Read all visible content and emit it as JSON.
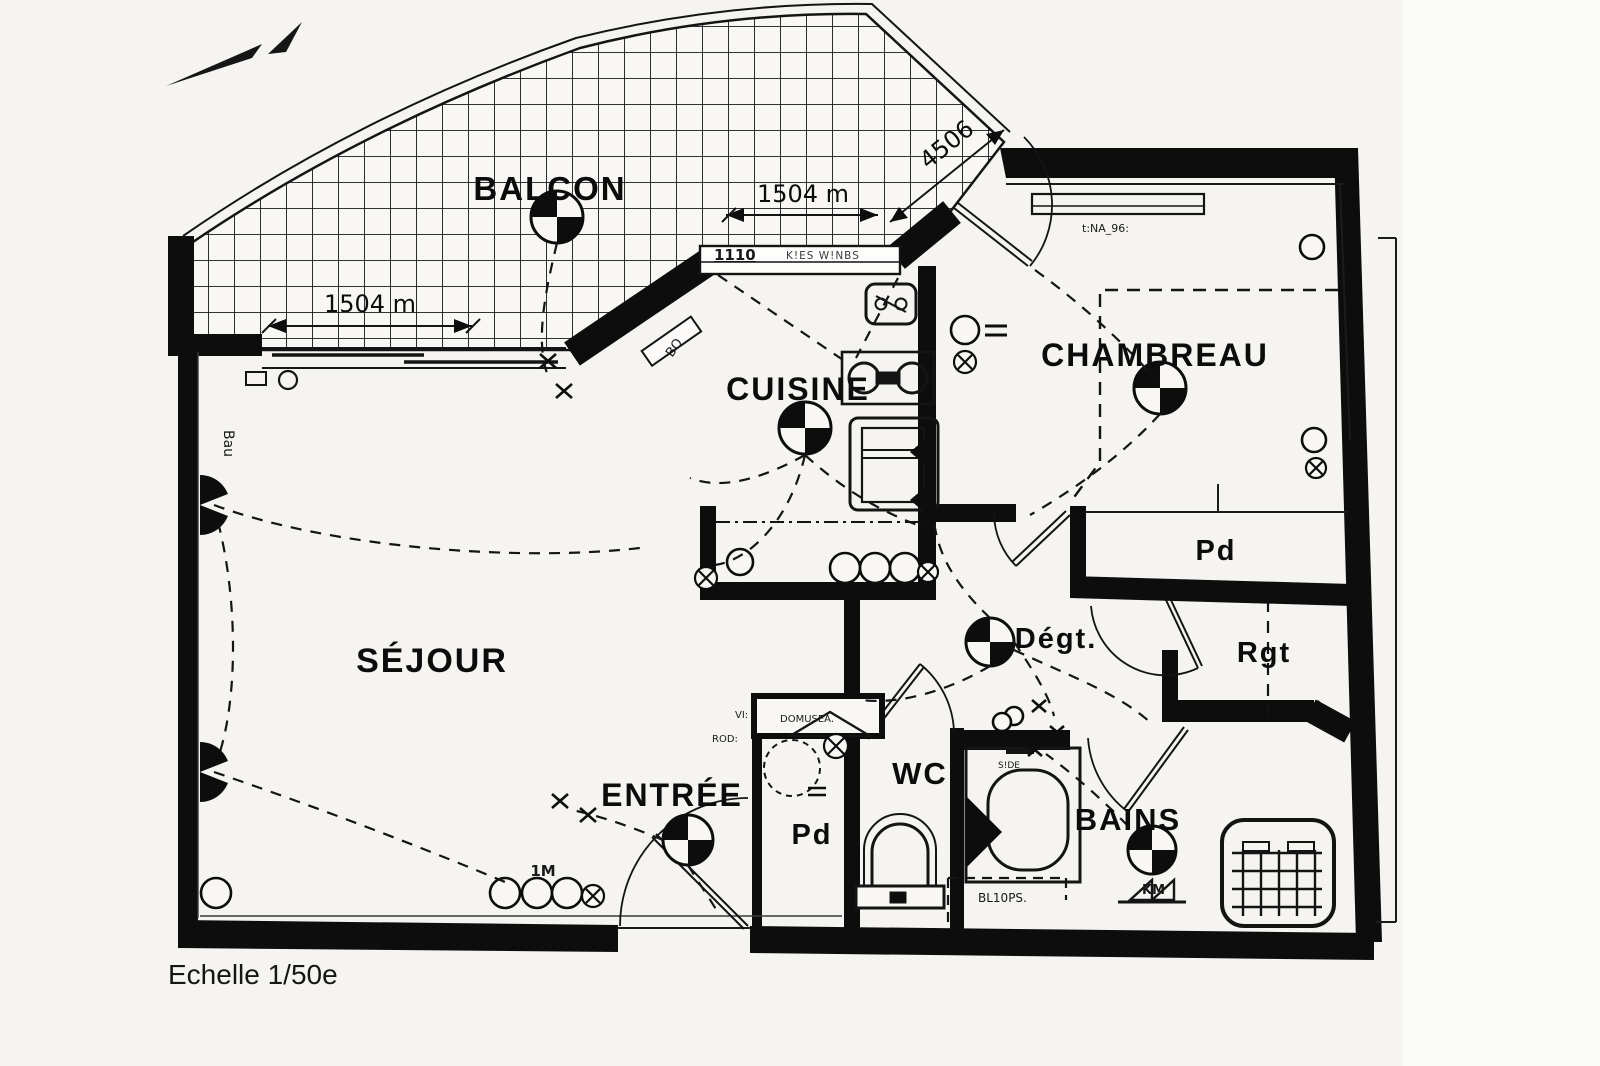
{
  "meta": {
    "scale_label": "Echelle 1/50e"
  },
  "rooms": {
    "balcon": "BALCON",
    "cuisine": "CUISINE",
    "chambre": "CHAMBREAU",
    "sejour": "SÉJOUR",
    "entree": "ENTRÉE",
    "wc": "WC",
    "bains": "BAINS",
    "degagement": "Dégt.",
    "placard_chambre": "Pd",
    "placard_entree": "Pd",
    "rangement": "Rgt"
  },
  "dimensions": {
    "balcony_width": "1504 m",
    "kitchen_front": "1504 m",
    "diagonal": "4506",
    "kitchen_window": "1110"
  },
  "annotations": {
    "outlet_group": "1M",
    "door_bo": "BO",
    "wall_bau": "Bau",
    "chambre_shelf": "t:NA_96:",
    "entree_closet": "DOMUSEA.",
    "entree_vi": "VI:",
    "entree_rod": "ROD:",
    "bains_note": "BL10PS.",
    "bains_km": "KM",
    "bains_side": "S!DE",
    "window_note": "K!ES W!NBS"
  }
}
